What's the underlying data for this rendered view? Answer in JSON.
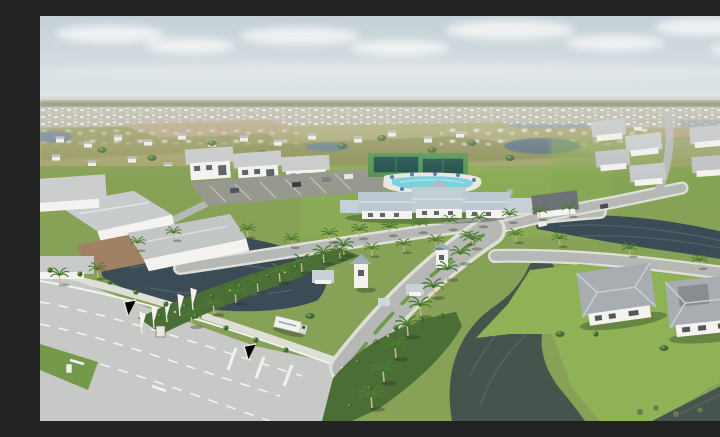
{
  "scene": {
    "type": "aerial-photograph",
    "description": "Aerial drone photograph of a new master-planned residential community on a clear hazy day: a palm-lined entrance boulevard with gatehouse towers and white banner flags leads from a wide arterial road intersection toward a clubhouse amenity center with a resort pool and dark-green sport courts; model homes and rows of new houses with grey hip roofs surround several dark retention ponds, with dense suburban development stretching to the horizon.",
    "setting": "Florida-style suburban new-construction neighborhood, midday, light overcast sky",
    "features": [
      "sky-with-clouds",
      "distant-development-horizon",
      "tree-line",
      "scrub-fields",
      "upper-left-pond",
      "bottom-center-pond",
      "right-pond",
      "corner-pond",
      "main-arterial-road",
      "grass-median",
      "lane-markings",
      "entrance-boulevard",
      "gatehouse-towers",
      "banner-flags",
      "entry-sign",
      "box-truck",
      "clubhouse",
      "resort-pool",
      "sport-courts",
      "pool-umbrellas",
      "model-homes-row",
      "sales-parking-lot",
      "left-model-homes",
      "right-home-cluster",
      "peninsula-houses",
      "palm-tree-rows",
      "shrub-beds",
      "street-lights"
    ],
    "visible_text": "none legible"
  },
  "palette": {
    "sky_top": "#c3cfd6",
    "sky_low": "#e4e9ea",
    "cloud": "#f2f4f5",
    "haze": "#cbc7ba",
    "distant": "#b6b1a3",
    "treeline": "#5e6b44",
    "field": "#a5a26b",
    "field_olive": "#96985c",
    "field_tan": "#b3a37f",
    "grass": "#87a156",
    "grass_dark": "#5f8a41",
    "lawn_bright": "#8fb257",
    "water_dark": "#3c4c57",
    "water_green": "#46544d",
    "water_ripple": "#5a6a72",
    "road": "#b6b8b5",
    "road_light": "#c7c9c6",
    "sidewalk": "#dedfd7",
    "marking": "#f2f3ef",
    "roof_light": "#c9cccc",
    "roof_mid": "#a8adb1",
    "roof_dark": "#6d7276",
    "roof_blue": "#bcc9d0",
    "wall": "#f4f3ef",
    "dirt": "#a08163",
    "pool": "#7cd2dc",
    "court": "#20504a",
    "court_fence": "#4f9357",
    "palm_frond": "#4d7c33",
    "palm_trunk": "#c9b894",
    "umbrella": "#3b6ca8",
    "shadow": "rgba(35,48,30,0.35)"
  }
}
